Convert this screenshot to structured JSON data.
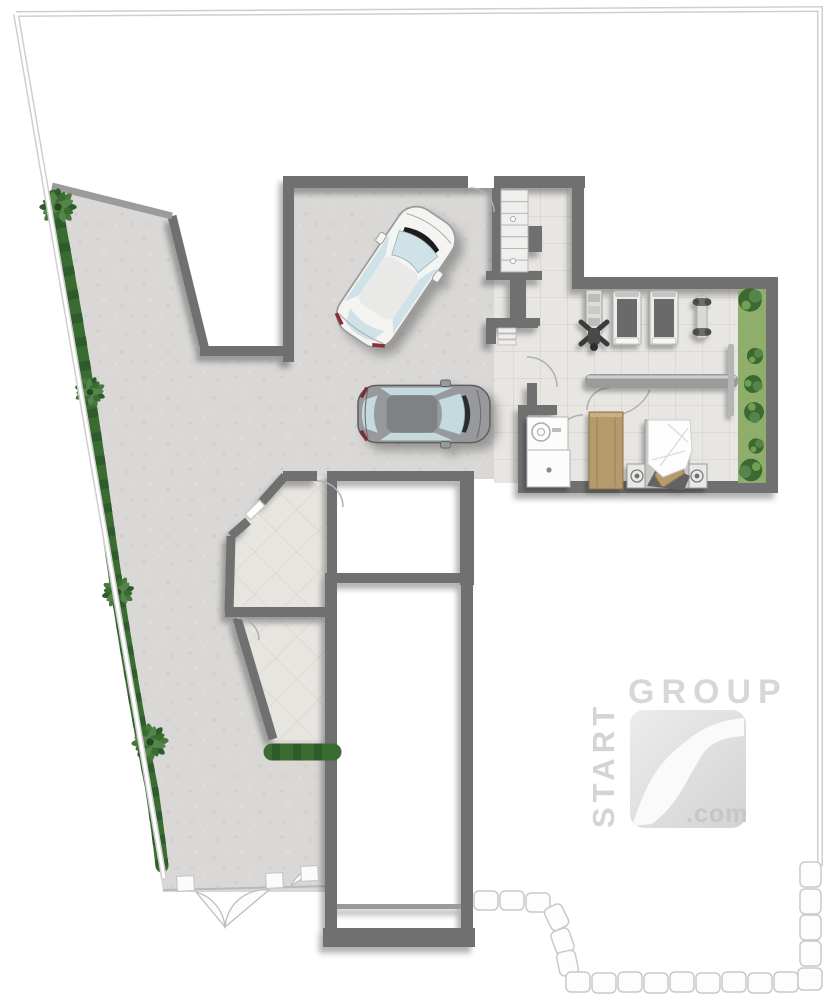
{
  "watermark": {
    "brand_top": "GROUP",
    "brand_side": "START",
    "brand_suffix": ".com"
  },
  "palette": {
    "wall": "#6f6f6f",
    "wall_light": "#9b9b9b",
    "concrete": "#d9d8d6",
    "tile": "#e8e6e2",
    "tile_line": "#d0cdc7",
    "boundary": "#cfcfcf",
    "hedge_dark": "#2e5b2c",
    "hedge_mid": "#47793a",
    "grass": "#8fae6c",
    "bush": "#3c6832",
    "wood": "#b59a6c",
    "car_white_body": "#f4f4f2",
    "car_grey_body": "#97999c",
    "glass": "#cfe2e8",
    "stone": "#fdfdfd",
    "logo_grey": "#d7d7d7"
  },
  "plan": {
    "type": "basement floor plan rendering",
    "elements": [
      "plot-boundary",
      "stone-wall",
      "driveway",
      "hedge",
      "palm-trees",
      "garage",
      "staircase",
      "hallway",
      "gym",
      "treadmill",
      "treadmill",
      "weight-machine",
      "dumbbell-rack",
      "garden-strip",
      "bathroom",
      "wardrobe",
      "bed",
      "white-car",
      "grey-car",
      "entrance-gate",
      "storage-rooms",
      "void-rooms",
      "watermark-logo"
    ]
  }
}
